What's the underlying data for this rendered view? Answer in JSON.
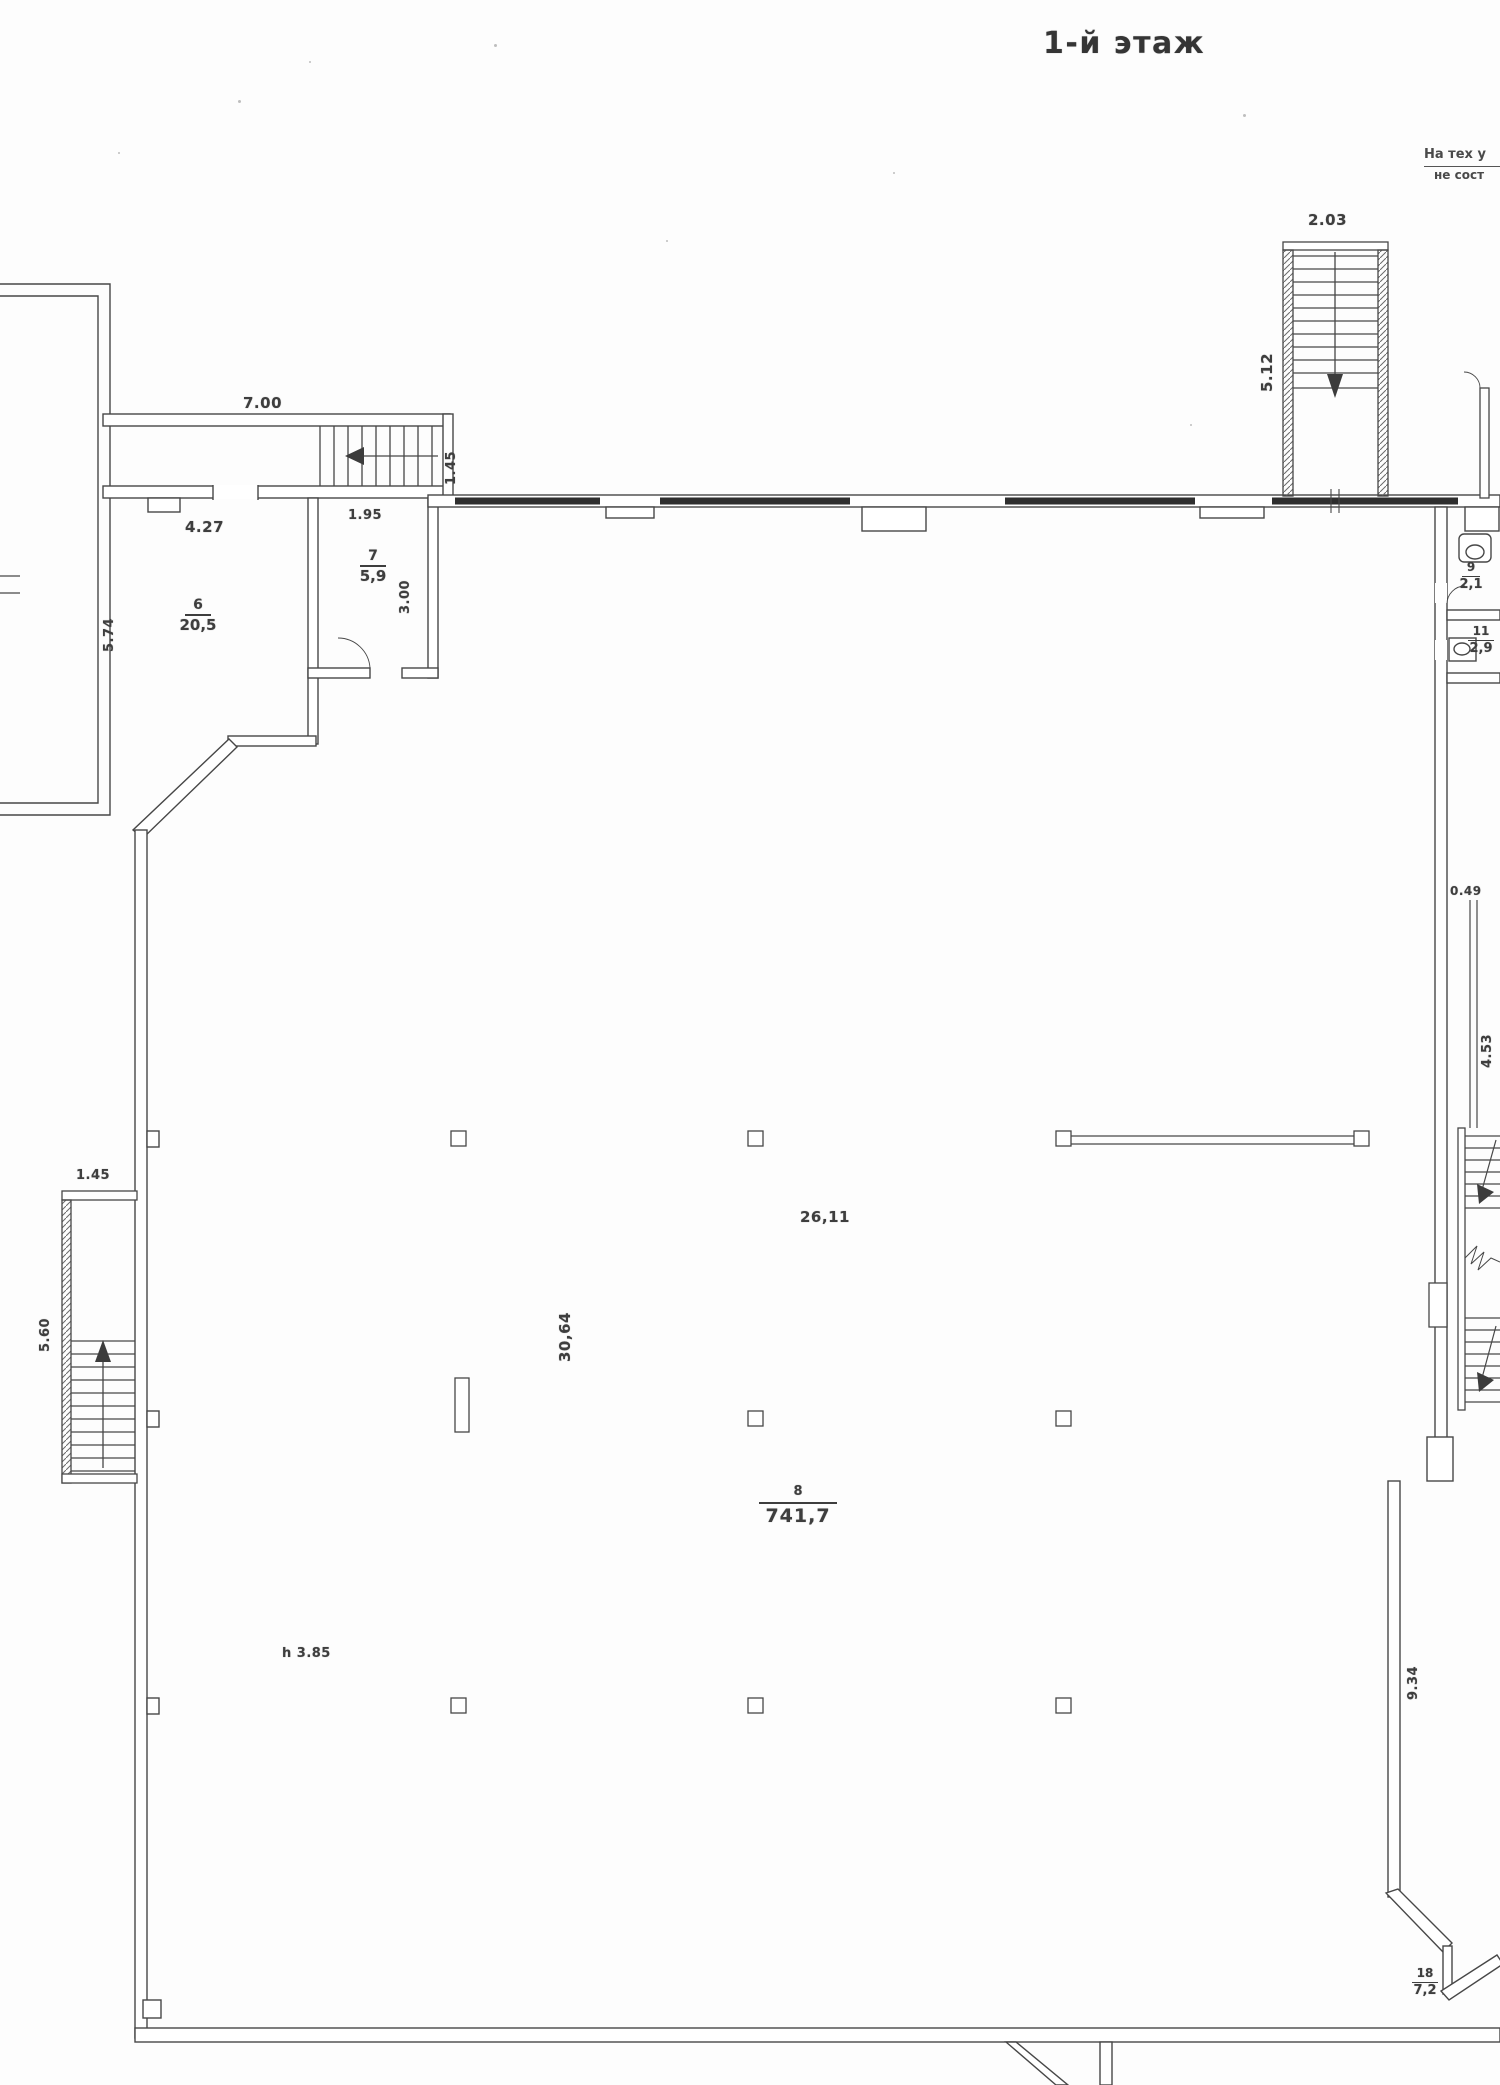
{
  "title": "1-й этаж",
  "note": {
    "line1": "На тех у",
    "line2": "не сост"
  },
  "rooms": {
    "r6": {
      "num": "6",
      "area": "20,5"
    },
    "r7": {
      "num": "7",
      "area": "5,9"
    },
    "r8": {
      "num": "8",
      "area": "741,7"
    },
    "r9": {
      "num": "9",
      "area": "2,1"
    },
    "r11": {
      "num": "11",
      "area": "2,9"
    },
    "r18": {
      "num": "18",
      "area": "7,2"
    }
  },
  "dims": {
    "top_stair_width": "2.03",
    "top_stair_length": "5.12",
    "entry_wall": "7.00",
    "entry_stair_width": "1.45",
    "room6_width": "4.27",
    "room6_depth": "5.74",
    "room7_width": "1.95",
    "room7_depth": "3.00",
    "left_stair_width": "1.45",
    "left_stair_length": "5.60",
    "hall_width": "26,11",
    "hall_depth": "30,64",
    "hall_height": "h 3.85",
    "niche": "0.49",
    "right_corridor": "4.53",
    "right_room_depth": "9.34"
  }
}
